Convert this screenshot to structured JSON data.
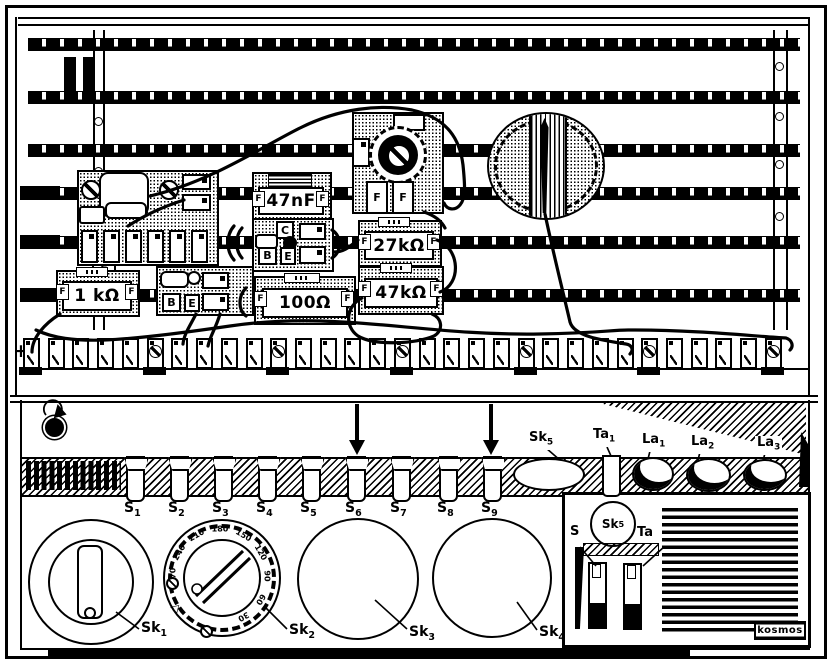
{
  "board": {
    "plus_label": "+",
    "clip_label": "F",
    "components": {
      "capacitor": {
        "value": "47nF"
      },
      "transistor1": {
        "pin_c": "C",
        "pin_b": "B",
        "pin_e": "E"
      },
      "transistor2": {
        "pin_b": "B",
        "pin_e": "E"
      },
      "resistor_1k": {
        "value": "1 kΩ"
      },
      "resistor_100": {
        "value": "100Ω"
      },
      "resistor_27k": {
        "value": "27kΩ"
      },
      "resistor_47k": {
        "value": "47kΩ"
      }
    }
  },
  "front_panel": {
    "switch_labels": [
      {
        "base": "S",
        "sub": "1"
      },
      {
        "base": "S",
        "sub": "2"
      },
      {
        "base": "S",
        "sub": "3"
      },
      {
        "base": "S",
        "sub": "4"
      },
      {
        "base": "S",
        "sub": "5"
      },
      {
        "base": "S",
        "sub": "6"
      },
      {
        "base": "S",
        "sub": "7"
      },
      {
        "base": "S",
        "sub": "8"
      },
      {
        "base": "S",
        "sub": "9"
      }
    ],
    "top_labels": {
      "sk5": {
        "base": "Sk",
        "sub": "5"
      },
      "ta1": {
        "base": "Ta",
        "sub": "1"
      },
      "la1": {
        "base": "La",
        "sub": "1"
      },
      "la2": {
        "base": "La",
        "sub": "2"
      },
      "la3": {
        "base": "La",
        "sub": "3"
      }
    },
    "knob_labels": {
      "sk1": {
        "base": "Sk",
        "sub": "1"
      },
      "sk2": {
        "base": "Sk",
        "sub": "2"
      },
      "sk3": {
        "base": "Sk",
        "sub": "3"
      },
      "sk4": {
        "base": "Sk",
        "sub": "4"
      }
    },
    "dial_numbers": [
      "30",
      "60",
      "90",
      "120",
      "150",
      "180",
      "210",
      "240",
      "270"
    ],
    "dial_index_mark": "◁",
    "inset": {
      "s_label": "S",
      "sk5": {
        "base": "Sk",
        "sub": "5"
      },
      "ta_label": "Ta",
      "brand": "kosmos"
    }
  }
}
